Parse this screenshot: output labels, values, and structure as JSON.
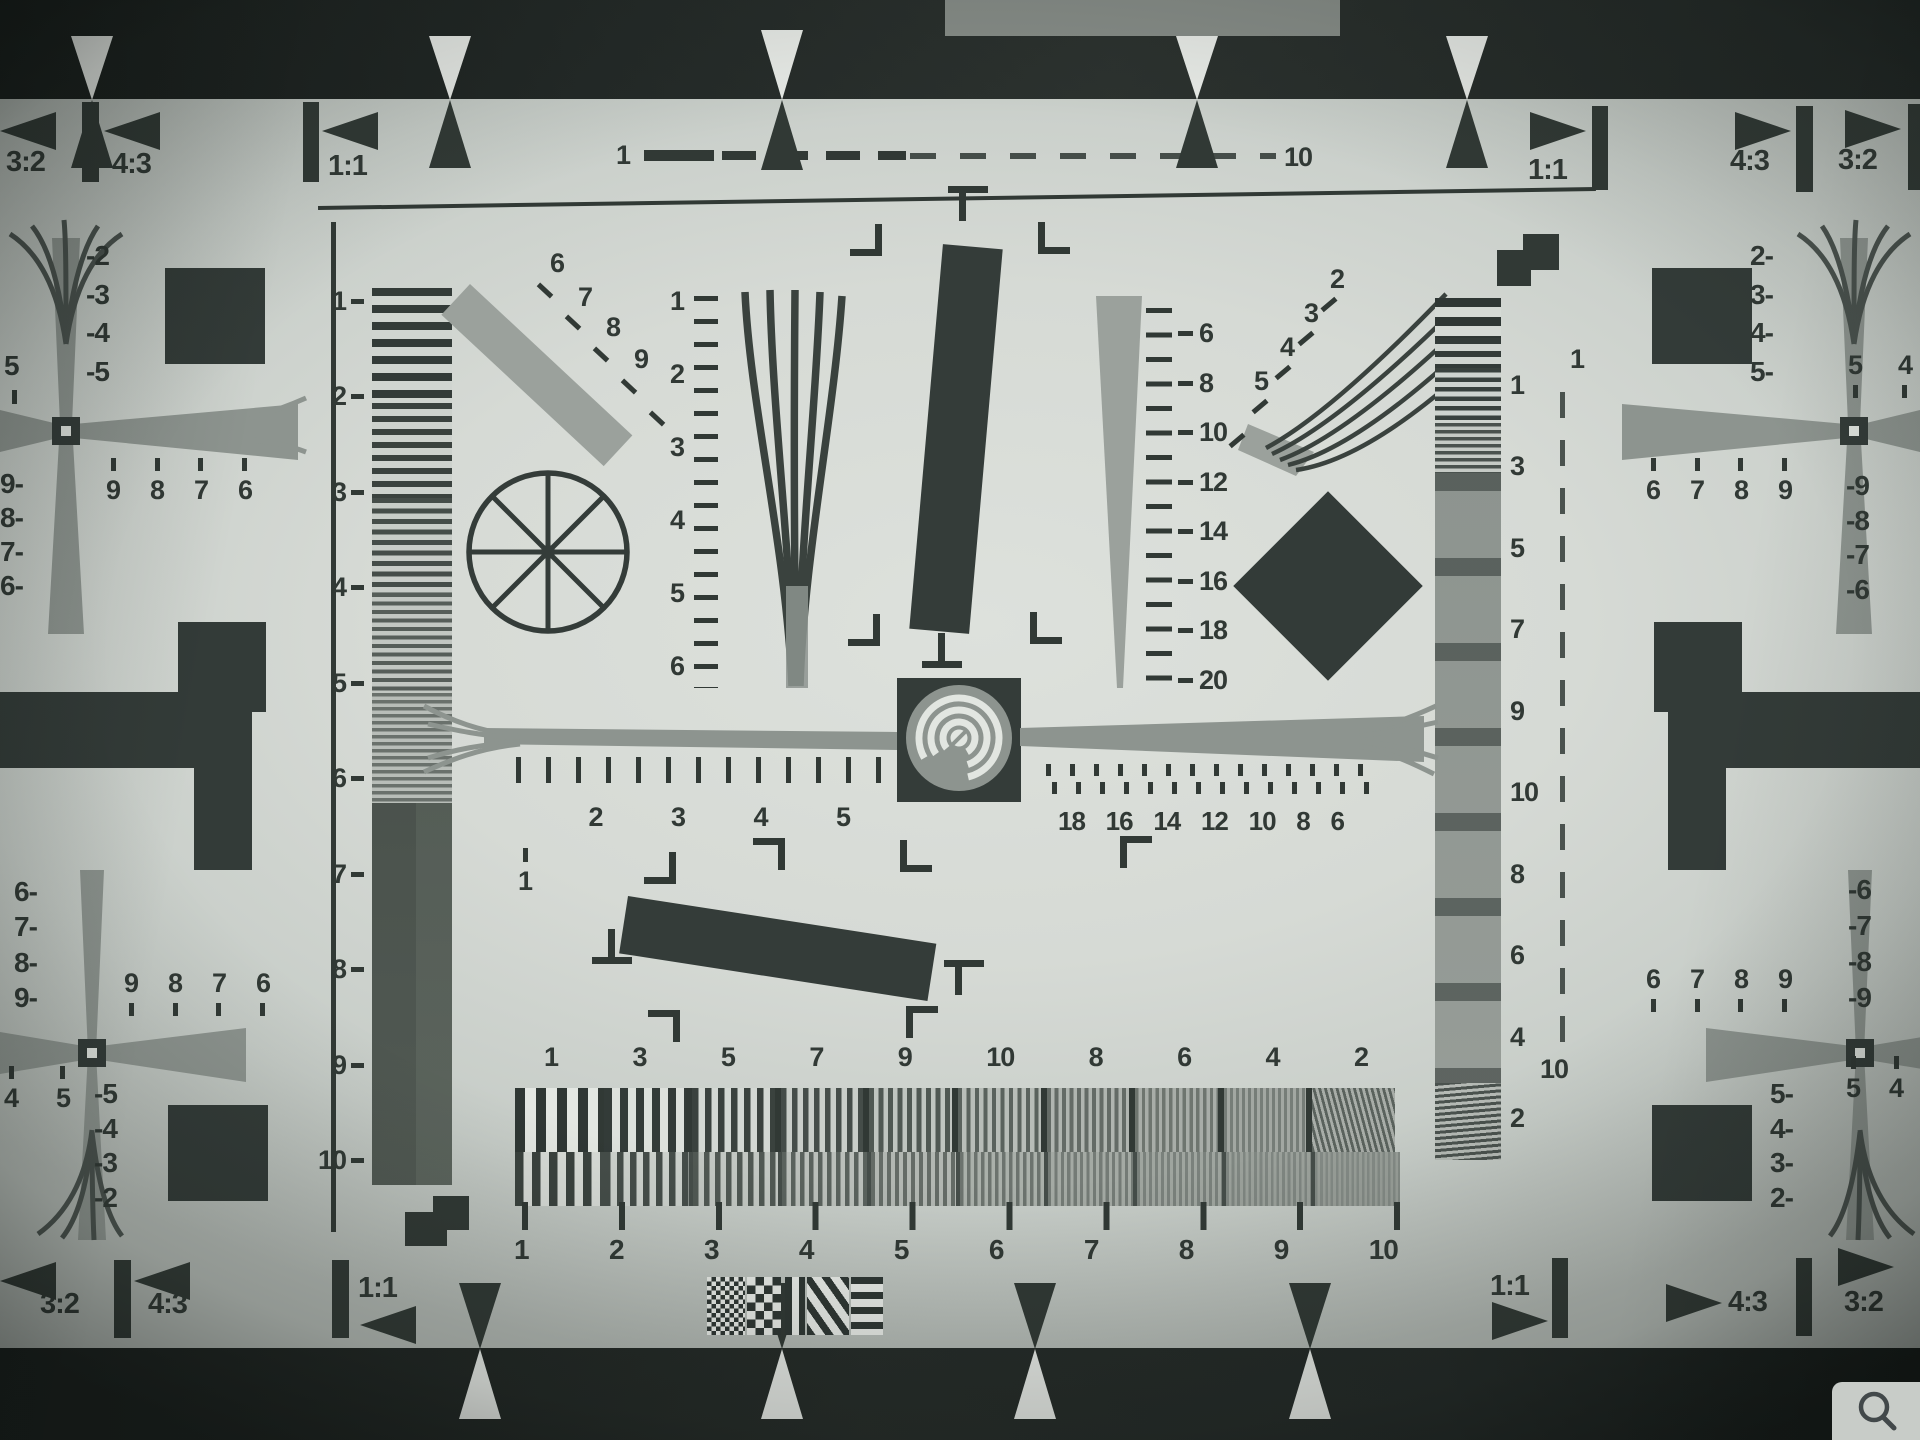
{
  "colors": {
    "ink": "#313935",
    "grey": "#8d948f",
    "lightgrey": "#9ba19c",
    "chart": "#d6dad5",
    "band": "#202523",
    "paper": "#e8ebe7"
  },
  "top_edge": {
    "left": [
      "3:2",
      "4:3",
      "1:1"
    ],
    "scale_start": "1",
    "scale_end": "10",
    "right": [
      "1:1",
      "4:3",
      "3:2"
    ]
  },
  "bottom_edge": {
    "left": [
      "3:2",
      "4:3",
      "1:1"
    ],
    "right": [
      "1:1",
      "4:3",
      "3:2"
    ]
  },
  "left_strip": {
    "labels": [
      "1",
      "2",
      "3",
      "4",
      "5",
      "6",
      "7",
      "8",
      "9",
      "10"
    ]
  },
  "right_strip": {
    "labels": [
      "1",
      "3",
      "5",
      "7",
      "9",
      "10",
      "8",
      "6",
      "4",
      "2"
    ],
    "dash_top": "1",
    "dash_bottom": "10"
  },
  "nw_bar_labels": [
    "6",
    "7",
    "8",
    "9"
  ],
  "center_fan_scale": [
    "1",
    "2",
    "3",
    "4",
    "5",
    "6"
  ],
  "right_wedge_scale": [
    "6",
    "8",
    "10",
    "12",
    "14",
    "16",
    "18",
    "20"
  ],
  "ne_fan_labels": [
    "2",
    "3",
    "4",
    "5"
  ],
  "left_arm_scale": [
    "1",
    "2",
    "3",
    "4",
    "5"
  ],
  "right_arm_scale": [
    "18",
    "16",
    "14",
    "12",
    "10",
    "8",
    "6"
  ],
  "burst": {
    "top_labels": [
      "1",
      "3",
      "5",
      "7",
      "9",
      "10",
      "8",
      "6",
      "4",
      "2"
    ],
    "bottom_labels": [
      "1",
      "2",
      "3",
      "4",
      "5",
      "6",
      "7",
      "8",
      "9",
      "10"
    ]
  },
  "crosses": {
    "top_left": {
      "wedge": [
        "-2",
        "-3",
        "-4",
        "-5"
      ],
      "outer": "5",
      "row": [
        "9",
        "8",
        "7",
        "6"
      ],
      "outer_col": [
        "9-",
        "8-",
        "7-",
        "6-"
      ]
    },
    "bottom_left": {
      "outer_col": [
        "6-",
        "7-",
        "8-",
        "9-"
      ],
      "row": [
        "9",
        "8",
        "7",
        "6"
      ],
      "inner_col": [
        "-5",
        "-4",
        "-3",
        "-2"
      ],
      "outer_row": [
        "4",
        "5"
      ]
    },
    "top_right": {
      "wedge": [
        "2-",
        "3-",
        "4-",
        "5-"
      ],
      "outer_row": [
        "5",
        "4"
      ],
      "row": [
        "6",
        "7",
        "8",
        "9"
      ],
      "outer_col": [
        "-9",
        "-8",
        "-7",
        "-6"
      ]
    },
    "bottom_right": {
      "outer_col": [
        "-6",
        "-7",
        "-8",
        "-9"
      ],
      "row": [
        "6",
        "7",
        "8",
        "9"
      ],
      "inner_col": [
        "5-",
        "4-",
        "3-",
        "2-"
      ],
      "outer_row": [
        "5",
        "4",
        "3"
      ]
    }
  },
  "overlay": {
    "zoom_icon": "magnifying-glass"
  }
}
